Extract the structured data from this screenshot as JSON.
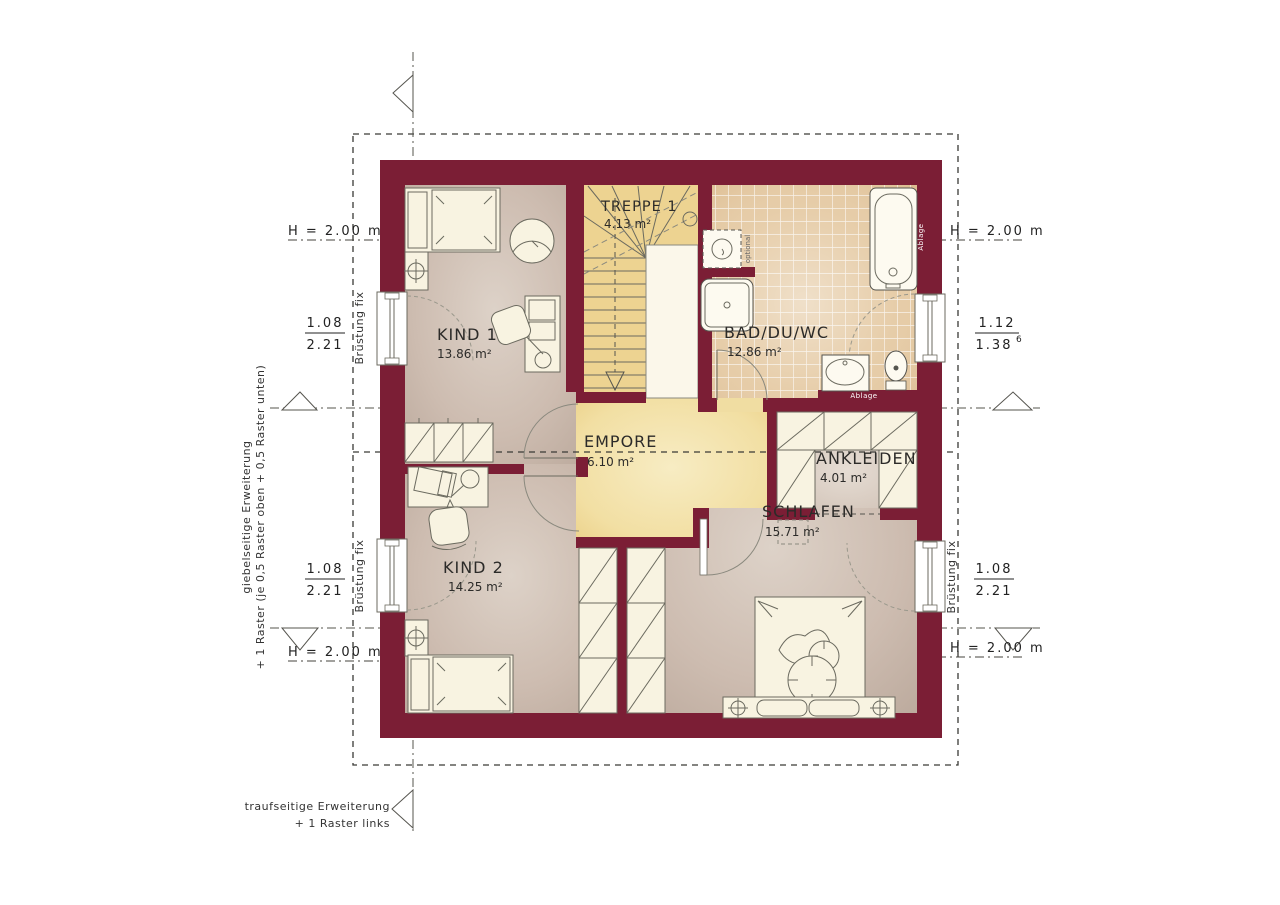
{
  "plan_type": "floor-plan",
  "rooms": {
    "treppe": {
      "name": "TREPPE 1",
      "area": "4.13 m²"
    },
    "bad": {
      "name": "BAD/DU/WC",
      "area": "12.86 m²"
    },
    "kind1": {
      "name": "KIND 1",
      "area": "13.86 m²"
    },
    "empore": {
      "name": "EMPORE",
      "area": "6.10 m²"
    },
    "ankleiden": {
      "name": "ANKLEIDEN",
      "area": "4.01 m²"
    },
    "kind2": {
      "name": "KIND 2",
      "area": "14.25 m²"
    },
    "schlafen": {
      "name": "SCHLAFEN",
      "area": "15.71 m²"
    }
  },
  "dimensions": {
    "height_label": "H = 2.00 m",
    "parapet_label": "Brüstung fix",
    "windows": {
      "left_top": {
        "width": "1.08",
        "height": "2.21"
      },
      "left_bottom": {
        "width": "1.08",
        "height": "2.21"
      },
      "right_top": {
        "width": "1.12",
        "height": "1.38",
        "height_sup": "6"
      },
      "right_bottom": {
        "width": "1.08",
        "height": "2.21"
      }
    }
  },
  "annotations": {
    "gable_line1": "giebelseitige Erweiterung",
    "gable_line2": "+ 1 Raster (je 0,5 Raster oben + 0,5 Raster unten)",
    "eaves_line1": "traufseitige Erweiterung",
    "eaves_line2": "+ 1 Raster links",
    "shelf_label": "Ablage",
    "tub_shelf_label": "Ablage",
    "optional_label": "optional"
  },
  "colors": {
    "wall": "#7b1e35",
    "floor_base": "#c2b0a3",
    "floor_light": "#ddd2c8",
    "tile": "#e3c69d",
    "stair_yellow": "#edd391",
    "empore_yellow_center": "#f7ecc3",
    "empore_yellow_edge": "#eace84",
    "furniture": "#f8f3e1",
    "line": "#55544e"
  }
}
